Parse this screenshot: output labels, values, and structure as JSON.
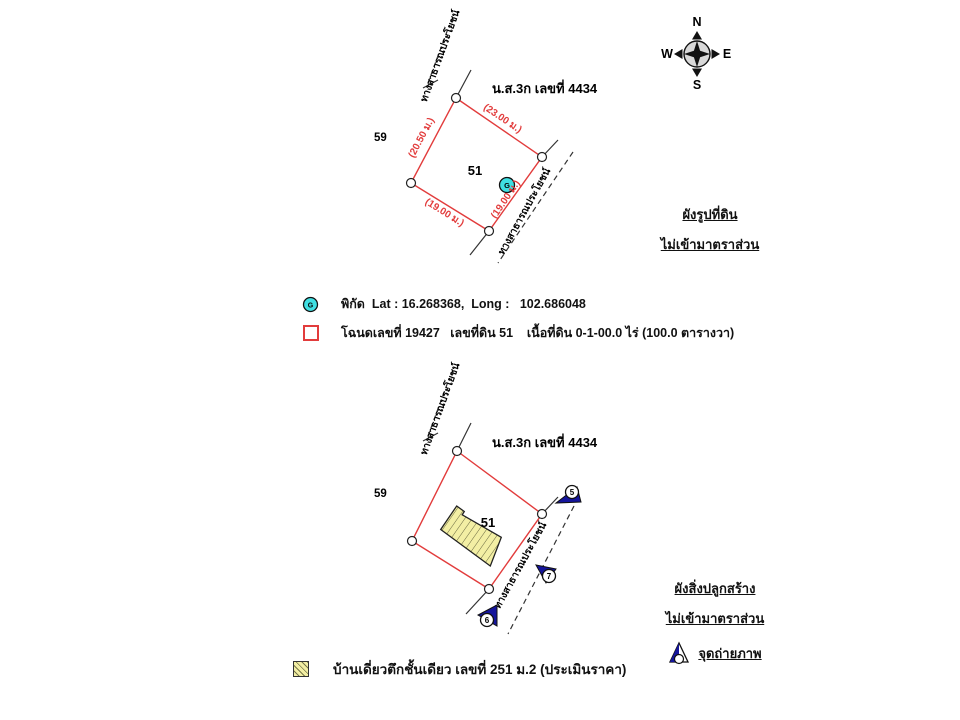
{
  "compass": {
    "north": "N",
    "east": "E",
    "south": "S",
    "west": "W"
  },
  "colors": {
    "boundary_red": "#e23c3c",
    "marker_cyan": "#3fdfe2",
    "building_yellow": "#f3efa4",
    "camera_navy": "#15159c"
  },
  "plot_diagram": {
    "heading": "ผังรูปที่ดิน",
    "scale_note": "ไม่เข้ามาตราส่วน",
    "doc_ref": "น.ส.3ก เลขที่ 4434",
    "neighbor_parcel": "59",
    "parcel_number": "51",
    "road_label": "ทางสาธารณประโยชน์",
    "dim_nw": "(20.50 ม.)",
    "dim_ne": "(23.00 ม.)",
    "dim_sw": "(19.00 ม.)",
    "dim_se": "(19.00 ม.)",
    "g_marker": "G"
  },
  "plot_legend": {
    "g_marker": "G",
    "coordinates": "พิกัด  Lat : 16.268368,  Long :   102.686048",
    "deed_info": "โฉนดเลขที่ 19427   เลขที่ดิน 51    เนื้อที่ดิน 0-1-00.0 ไร่ (100.0 ตารางวา)"
  },
  "building_diagram": {
    "heading": "ผังสิ่งปลูกสร้าง",
    "scale_note": "ไม่เข้ามาตราส่วน",
    "photo_point_label": "จุดถ่ายภาพ",
    "doc_ref": "น.ส.3ก เลขที่ 4434",
    "neighbor_parcel": "59",
    "parcel_number": "51",
    "road_label": "ทางสาธารณประโยชน์",
    "camera_points": {
      "p5": "5",
      "p6": "6",
      "p7": "7"
    }
  },
  "building_legend": {
    "description": "บ้านเดี่ยวตึกชั้นเดียว เลขที่ 251 ม.2 (ประเมินราคา)"
  }
}
